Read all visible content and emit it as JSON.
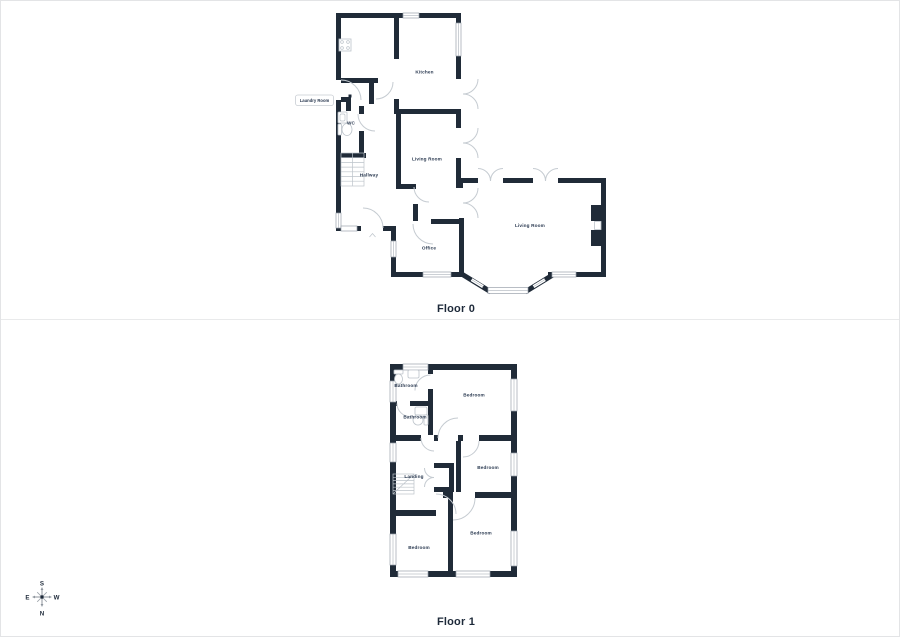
{
  "colors": {
    "wall": "#202b38",
    "door_arc": "#c5cbd1",
    "window_line": "#9aa2ab",
    "room_label": "#2a3950",
    "floor_title": "#1d2939",
    "divider": "#e9eaeb",
    "page_border": "#e3e4e6",
    "compass": "#8f969e"
  },
  "floor0": {
    "title": "Floor 0",
    "rooms": {
      "kitchen": "Kitchen",
      "living_room_small": "Living Room",
      "living_room_large": "Living Room",
      "hallway": "Hallway",
      "wc": "WC",
      "office": "Office",
      "laundry_room": "Laundry Room"
    }
  },
  "floor1": {
    "title": "Floor 1",
    "rooms": {
      "bathroom_top": "Bathroom",
      "bathroom_middle": "Bathroom",
      "bedroom_top_right": "Bedroom",
      "bedroom_right": "Bedroom",
      "bedroom_bottom_right": "Bedroom",
      "bedroom_bottom_left": "Bedroom",
      "landing": "Landing"
    }
  },
  "compass": {
    "south": "S",
    "north": "N",
    "east": "E",
    "west": "W"
  }
}
